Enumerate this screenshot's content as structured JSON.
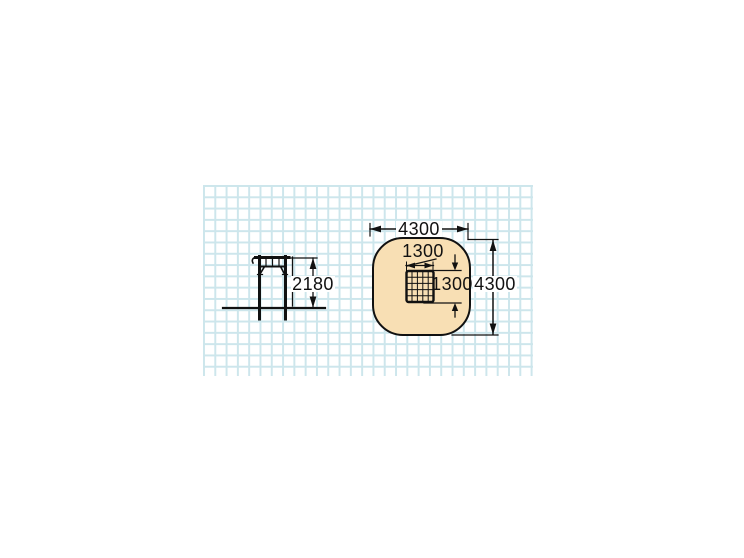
{
  "drawing": {
    "type": "playground climbing net - dimensioned technical drawing",
    "grid": {
      "line_color": "#cde6ec",
      "cell_px": 11.3,
      "paper_color": "#ffffff"
    },
    "line_color": "#111111",
    "side_view": {
      "height_dimension": "2180"
    },
    "plan_view": {
      "safety_zone_fill": "#f8dfb4",
      "safety_zone_width_dimension": "4300",
      "safety_zone_height_dimension": "4300",
      "net_width_dimension": "1300",
      "net_height_dimension": "1300"
    }
  }
}
